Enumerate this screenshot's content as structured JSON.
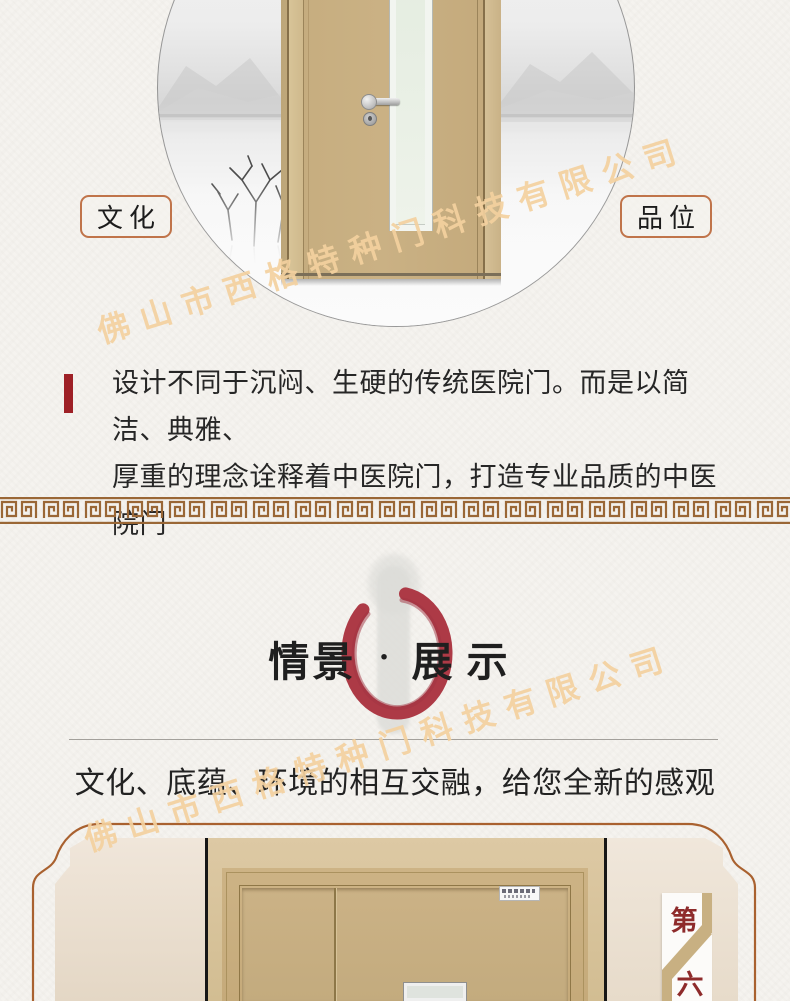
{
  "watermark": {
    "text": "佛山市西格特种门科技有限公司",
    "color": "#f3d0a0"
  },
  "hero": {
    "label_left": "文化",
    "label_right": "品位",
    "badge_border_color": "#c0744a"
  },
  "intro": {
    "accent_color": "#9e2026",
    "line1": "设计不同于沉闷、生硬的传统医院门。而是以简洁、典雅、",
    "line2": "厚重的理念诠释着中医院门，打造专业品质的中医院门"
  },
  "divider_band": {
    "style": "greek-key",
    "color": "#9a6736"
  },
  "showcase": {
    "title_left": "情景",
    "title_separator": "·",
    "title_right": "展示",
    "enso_color": "#ad3a46",
    "subtitle": "文化、底蕴、环境的相互交融，给您全新的感观"
  },
  "gallery": {
    "frame_color": "#a9612f",
    "chapter_marker": {
      "char_top": "第",
      "char_bottom": "六",
      "text_color": "#8e2b2b"
    }
  }
}
